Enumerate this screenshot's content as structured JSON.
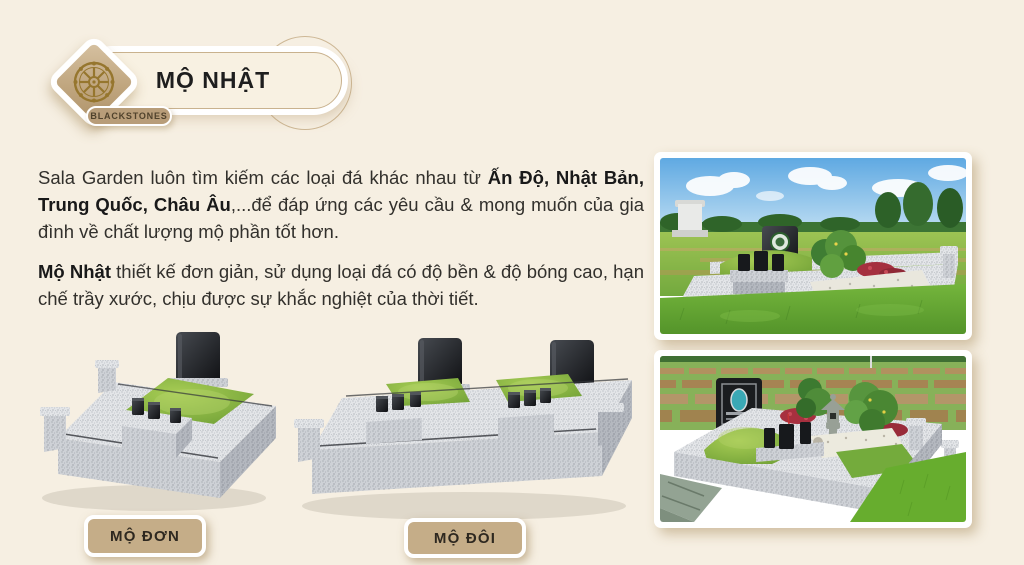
{
  "header": {
    "title": "MỘ NHẬT",
    "brand": "BLACKSTONES"
  },
  "intro": {
    "text_before_bold": "Sala Garden luôn tìm kiếm các loại đá khác nhau từ ",
    "bold_text": "Ấn Độ, Nhật Bản, Trung Quốc, Châu Âu",
    "text_after_bold": ",...để đáp ứng các yêu cầu & mong muốn của gia đình về chất lượng mộ phần tốt hơn."
  },
  "description": {
    "bold_text": "Mộ Nhật",
    "text_after_bold": " thiết kế đơn giản, sử dụng loại đá có độ bền & độ bóng cao, hạn chế trầy xước, chịu được sự khắc nghiệt của thời tiết."
  },
  "captions": {
    "single": "MỘ ĐƠN",
    "double": "MỘ ĐÔI"
  },
  "colors": {
    "background": "#f6efe2",
    "accent_tan": "#c9b28e",
    "button_fill": "#c5ad88",
    "button_text": "#2e2820",
    "brand_pill_fill": "#b89d79",
    "title_text": "#1e1e1e",
    "body_text": "#32302c",
    "granite_light": "#e3e5e8",
    "grass_green": "#7fae3d",
    "headstone_black": "#141619",
    "logo_gold": "#96762e"
  }
}
